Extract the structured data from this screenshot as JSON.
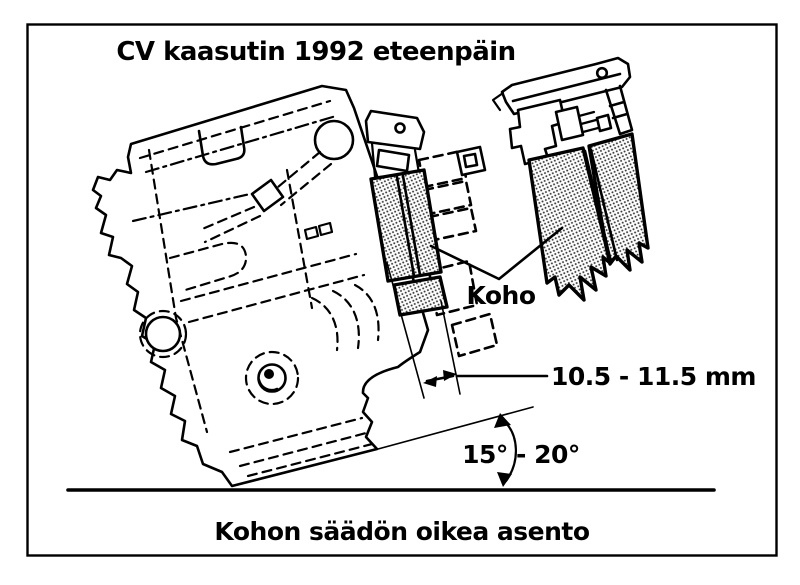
{
  "figure": {
    "title": "CV kaasutin 1992 eteenpäin",
    "caption": "Kohon säädön oikea asento",
    "labels": {
      "float_label": "Koho",
      "float_height_label": "10.5 - 11.5 mm",
      "angle_label": "15° - 20°"
    },
    "colors": {
      "ink": "#000000",
      "paper": "#ffffff"
    }
  }
}
